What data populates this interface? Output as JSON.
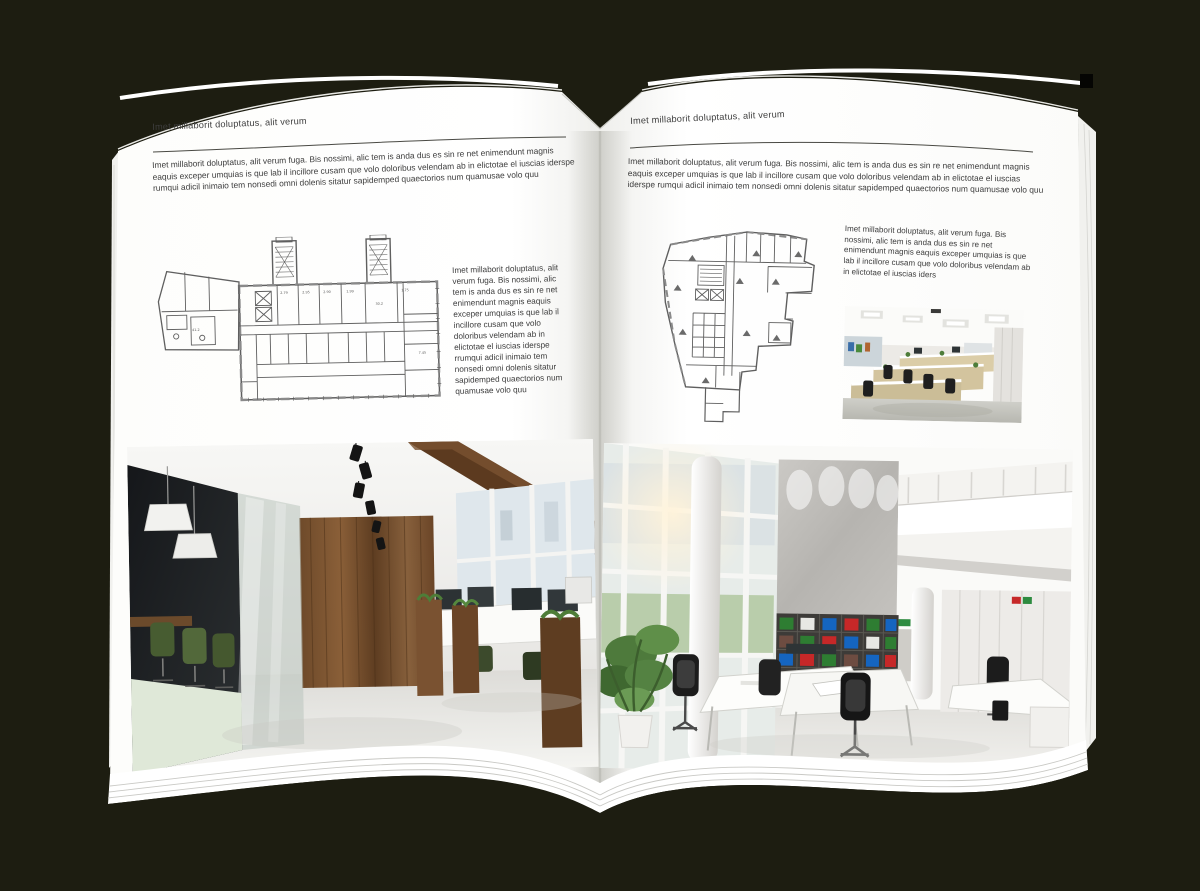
{
  "background_color": "#1d1d11",
  "page_color": "#ffffff",
  "text_color": "#3d3d3d",
  "left_page": {
    "header": "Imet millaborit doluptatus, alit verum",
    "intro": "Imet millaborit doluptatus, alit verum fuga. Bis nossimi, alic tem is anda dus es sin re net enimendunt magnis eaquis exceper umquias is que lab il incillore cusam que volo doloribus velendam ab in elictotae el iuscias iderspe rumqui adicil inimaio tem nonsedi omni dolenis sitatur sapidemped quaectorios num quamusae volo quu",
    "column_text": "Imet millaborit doluptatus, alit verum fuga. Bis nossimi, alic tem is anda dus es sin re net enimendunt magnis eaquis exceper umquias is que lab il incillore cusam que volo doloribus velendam ab in elictotae el iuscias iderspe rrumqui adicil inimaio tem nonsedi omni dolenis sitatur sapidemped quaectorios num quamusae volo quu",
    "floor_plan_annotations": [
      "2.79",
      "2.95",
      "2.90",
      "1.99",
      "1.75",
      "7.45",
      "30.2",
      "41.2"
    ]
  },
  "right_page": {
    "header": "Imet millaborit doluptatus, alit verum",
    "intro": "Imet millaborit doluptatus, alit verum fuga. Bis nossimi, alic tem is anda dus es sin re net enimendunt magnis eaquis exceper umquias is que lab il incillore cusam que volo doloribus velendam ab in elictotae el iuscias iderspe rumqui adicil inimaio tem nonsedi omni dolenis sitatur sapidemped quaectorios num quamusae volo quu",
    "column_text": "Imet millaborit doluptatus, alit verum fuga. Bis nossimi, alic tem is anda dus es sin re net enimendunt magnis eaquis exceper umquias is que lab il incillore cusam que volo doloribus velendam ab in elictotae el iuscias iders"
  }
}
